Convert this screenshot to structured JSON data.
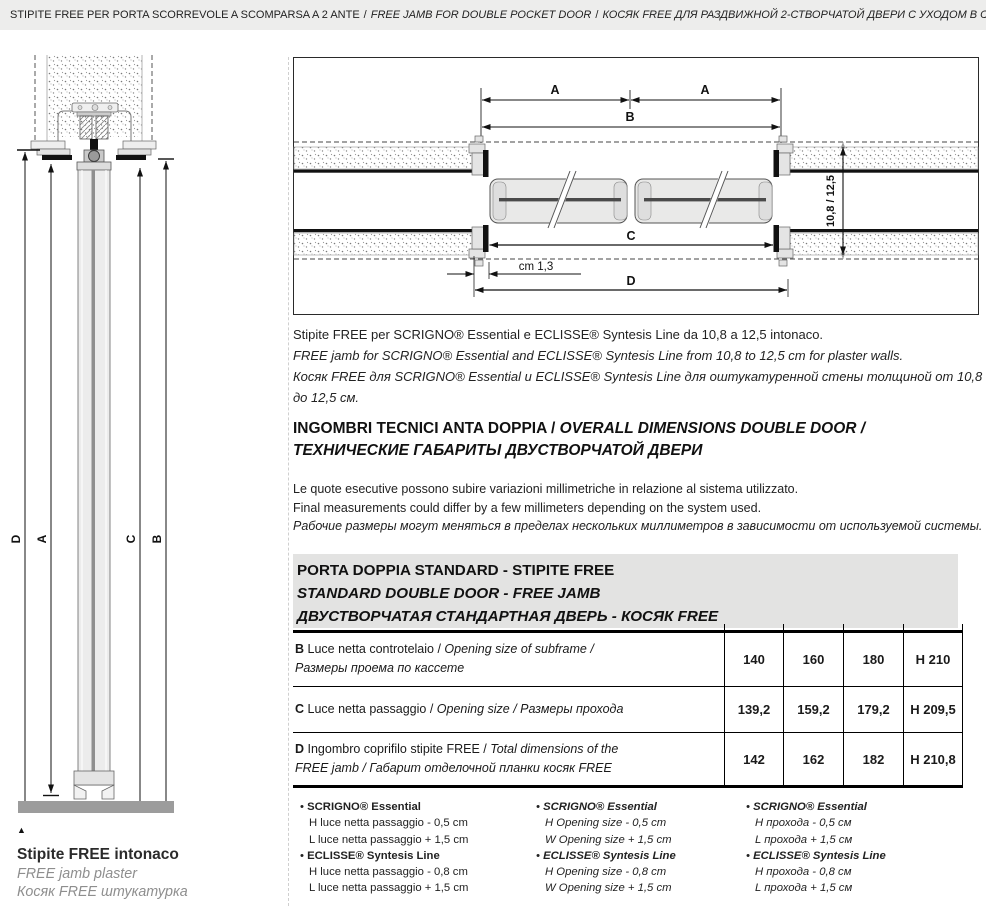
{
  "page_header": {
    "title_it": "STIPITE FREE PER PORTA SCORREVOLE A SCOMPARSA A 2 ANTE",
    "separator": "/",
    "title_en": "FREE JAMB FOR DOUBLE POCKET DOOR",
    "title_ru": "КОСЯК FREE ДЛЯ РАЗДВИЖНОЙ 2-СТВОРЧАТОЙ ДВЕРИ С УХОДОМ В СТЕНУ"
  },
  "left_drawing": {
    "dims": {
      "d": "D",
      "a": "A",
      "c": "C",
      "b": "B"
    },
    "caption": {
      "marker": "▲",
      "line_it": "Stipite FREE intonaco",
      "line_en": "FREE jamb plaster",
      "line_ru": "Косяк FREE  штукатурка"
    }
  },
  "top_drawing": {
    "dims": {
      "a_left": "A",
      "a_right": "A",
      "b": "B",
      "c": "C",
      "d": "D",
      "offset": "cm 1,3",
      "wall_thickness": "10,8 / 12,5"
    },
    "caption_it": "Stipite FREE per SCRIGNO® Essential e ECLISSE® Syntesis Line da 10,8 a 12,5 intonaco.",
    "caption_en": "FREE jamb for SCRIGNO® Essential and ECLISSE® Syntesis Line from 10,8 to 12,5 cm for plaster walls.",
    "caption_ru": "Косяк FREE для SCRIGNO® Essential и ECLISSE® Syntesis Line для оштукатуренной стены толщиной от 10,8 до 12,5 см."
  },
  "section": {
    "heading_it": "INGOMBRI TECNICI ANTA DOPPIA / ",
    "heading_en": "OVERALL DIMENSIONS DOUBLE DOOR /",
    "heading_ru": "ТЕХНИЧЕСКИЕ ГАБАРИТЫ ДВУСТВОРЧАТОЙ ДВЕРИ",
    "note_it": "Le quote esecutive possono subire variazioni millimetriche in relazione al sistema utilizzato.",
    "note_en": "Final measurements could differ by a few millimeters depending on the system used.",
    "note_ru": "Рабочие размеры могут меняться в пределах нескольких миллиметров в зависимости от используемой системы."
  },
  "table_bar": {
    "line_it": "PORTA DOPPIA STANDARD - STIPITE FREE",
    "line_en": "STANDARD DOUBLE DOOR - FREE JAMB",
    "line_ru": "ДВУСТВОРЧАТАЯ СТАНДАРТНАЯ ДВЕРЬ - КОСЯК FREE"
  },
  "table": {
    "rows": [
      {
        "key": "B",
        "desc_it": " Luce netta controtelaio / ",
        "desc_en": "Opening size of subframe /",
        "desc_ru": "Размеры проема по кассете",
        "values": [
          "140",
          "160",
          "180",
          "H 210"
        ]
      },
      {
        "key": "C",
        "desc_it": " Luce netta passaggio / ",
        "desc_en": "Opening size / ",
        "desc_ru": "Размеры прохода",
        "values": [
          "139,2",
          "159,2",
          "179,2",
          "H 209,5"
        ]
      },
      {
        "key": "D",
        "desc_it": " Ingombro coprifilo stipite FREE / ",
        "desc_en": "Total dimensions of the",
        "desc_en2": "FREE jamb / ",
        "desc_ru": "Габарит отделочной планки косяк FREE",
        "values": [
          "142",
          "162",
          "182",
          "H 210,8"
        ]
      }
    ]
  },
  "footnotes": {
    "bullet": "•",
    "col_it": {
      "items": [
        {
          "brand": "SCRIGNO® Essential",
          "l1": "H luce netta passaggio - 0,5 cm",
          "l2": "L luce netta passaggio + 1,5 cm"
        },
        {
          "brand": "ECLISSE® Syntesis Line",
          "l1": "H luce netta passaggio - 0,8 cm",
          "l2": "L luce netta passaggio + 1,5 cm"
        }
      ]
    },
    "col_en": {
      "items": [
        {
          "brand": "SCRIGNO® Essential",
          "l1": "H Opening size - 0,5 cm",
          "l2": "W Opening size + 1,5 cm"
        },
        {
          "brand": "ECLISSE® Syntesis Line",
          "l1": "H Opening size - 0,8 cm",
          "l2": "W Opening size + 1,5 cm"
        }
      ]
    },
    "col_ru": {
      "items": [
        {
          "brand": "SCRIGNO® Essential",
          "l1": "H прохода - 0,5 см",
          "l2": "L прохода + 1,5 см"
        },
        {
          "brand": "ECLISSE® Syntesis Line",
          "l1": "H прохода - 0,8 см",
          "l2": "L прохода + 1,5 см"
        }
      ]
    }
  },
  "colors": {
    "header_bg": "#ededec",
    "section_bar_bg": "#e3e3e2",
    "muted_text": "#8e8e8e",
    "floor_gray": "#9c9c9c"
  }
}
